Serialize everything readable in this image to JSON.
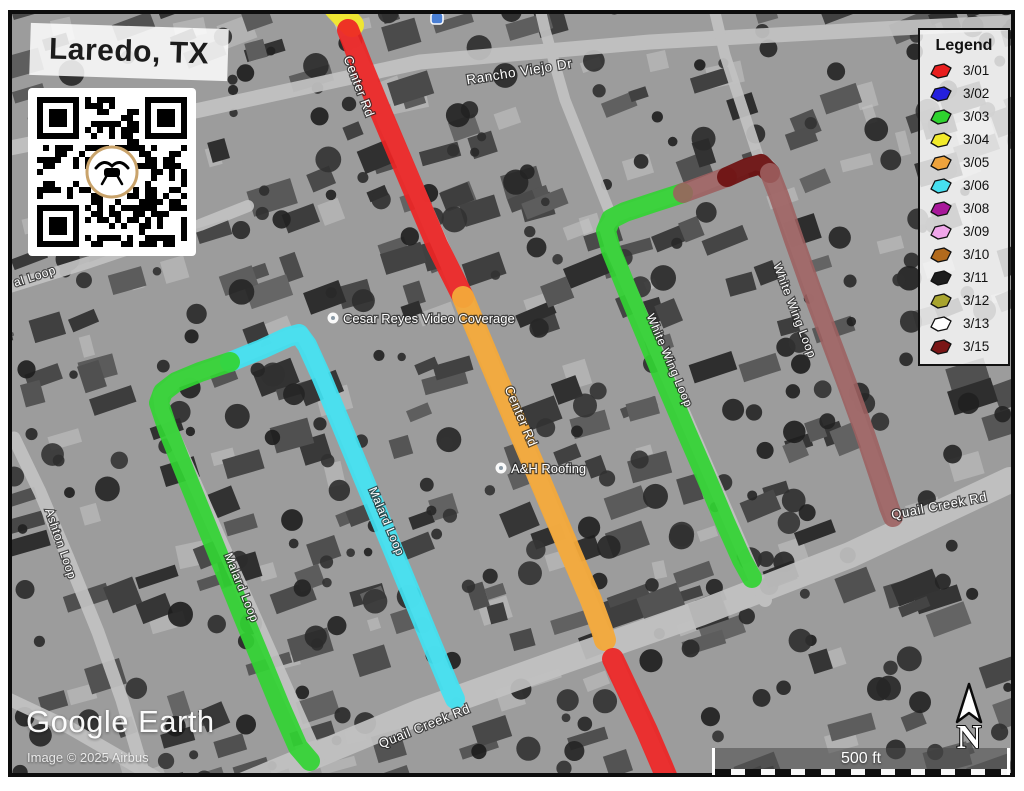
{
  "title": "Laredo, TX",
  "legend": {
    "title": "Legend",
    "entries": [
      {
        "date": "3/01",
        "color": "#e81e1e"
      },
      {
        "date": "3/02",
        "color": "#2420dd"
      },
      {
        "date": "3/03",
        "color": "#2ed32e"
      },
      {
        "date": "3/04",
        "color": "#f2ea2a"
      },
      {
        "date": "3/05",
        "color": "#eea33c"
      },
      {
        "date": "3/06",
        "color": "#46dff0"
      },
      {
        "date": "3/08",
        "color": "#a8189a"
      },
      {
        "date": "3/09",
        "color": "#f0a6ea"
      },
      {
        "date": "3/10",
        "color": "#b26a1c"
      },
      {
        "date": "3/11",
        "color": "#1c1c1c"
      },
      {
        "date": "3/12",
        "color": "#a8a42e"
      },
      {
        "date": "3/13",
        "color": "#ffffff"
      },
      {
        "date": "3/15",
        "color": "#7a1616"
      }
    ]
  },
  "map": {
    "routes": [
      {
        "date": "3/04",
        "name": "center-rd-yellow-stub",
        "color": "#f2e92c",
        "width": 24,
        "opacity": 0.95,
        "points": [
          [
            336,
            8
          ],
          [
            352,
            25
          ]
        ]
      },
      {
        "date": "3/01",
        "name": "center-rd-north",
        "color": "#ee2424",
        "width": 22,
        "opacity": 0.92,
        "points": [
          [
            348,
            30
          ],
          [
            362,
            66
          ],
          [
            380,
            110
          ],
          [
            399,
            155
          ],
          [
            418,
            200
          ],
          [
            437,
            245
          ],
          [
            456,
            283
          ],
          [
            463,
            297
          ]
        ]
      },
      {
        "date": "3/05",
        "name": "center-rd-mid",
        "color": "#f3a93a",
        "width": 22,
        "opacity": 0.95,
        "points": [
          [
            463,
            297
          ],
          [
            478,
            333
          ],
          [
            496,
            376
          ],
          [
            515,
            421
          ],
          [
            534,
            466
          ],
          [
            553,
            511
          ],
          [
            572,
            556
          ],
          [
            591,
            600
          ],
          [
            602,
            630
          ],
          [
            605,
            640
          ]
        ]
      },
      {
        "date": "3/01",
        "name": "center-rd-south",
        "color": "#ee2424",
        "width": 22,
        "opacity": 0.92,
        "points": [
          [
            613,
            659
          ],
          [
            630,
            695
          ],
          [
            647,
            731
          ],
          [
            662,
            766
          ],
          [
            669,
            783
          ]
        ]
      },
      {
        "date": "3/06",
        "name": "malard-loop-east",
        "color": "#41e2f2",
        "width": 20,
        "opacity": 0.92,
        "points": [
          [
            230,
            362
          ],
          [
            262,
            349
          ],
          [
            288,
            337
          ],
          [
            299,
            334
          ],
          [
            307,
            345
          ],
          [
            322,
            378
          ],
          [
            341,
            424
          ],
          [
            360,
            470
          ],
          [
            379,
            516
          ],
          [
            398,
            562
          ],
          [
            417,
            608
          ],
          [
            436,
            654
          ],
          [
            450,
            688
          ],
          [
            455,
            699
          ]
        ]
      },
      {
        "date": "3/03",
        "name": "malard-loop-west",
        "color": "#32d433",
        "width": 20,
        "opacity": 0.92,
        "points": [
          [
            230,
            362
          ],
          [
            200,
            372
          ],
          [
            176,
            382
          ],
          [
            163,
            392
          ],
          [
            159,
            403
          ],
          [
            168,
            430
          ],
          [
            186,
            475
          ],
          [
            205,
            522
          ],
          [
            224,
            569
          ],
          [
            243,
            616
          ],
          [
            262,
            662
          ],
          [
            280,
            706
          ],
          [
            298,
            747
          ],
          [
            310,
            761
          ]
        ]
      },
      {
        "date": "3/03",
        "name": "white-wing-loop-west",
        "color": "#32d433",
        "width": 20,
        "opacity": 0.92,
        "points": [
          [
            683,
            193
          ],
          [
            652,
            203
          ],
          [
            625,
            212
          ],
          [
            611,
            219
          ],
          [
            606,
            231
          ],
          [
            611,
            250
          ],
          [
            628,
            292
          ],
          [
            647,
            338
          ],
          [
            666,
            384
          ],
          [
            686,
            431
          ],
          [
            706,
            477
          ],
          [
            725,
            522
          ],
          [
            742,
            560
          ],
          [
            752,
            578
          ]
        ]
      },
      {
        "date": "3/15",
        "name": "white-wing-loop-north",
        "color": "#9d6060",
        "width": 20,
        "opacity": 0.88,
        "points": [
          [
            683,
            193
          ],
          [
            705,
            185
          ],
          [
            727,
            177
          ]
        ]
      },
      {
        "date": "3/15",
        "name": "white-wing-loop-corner",
        "color": "#6d1212",
        "width": 20,
        "opacity": 0.94,
        "points": [
          [
            727,
            177
          ],
          [
            747,
            168
          ],
          [
            761,
            164
          ],
          [
            770,
            173
          ]
        ]
      },
      {
        "date": "3/15",
        "name": "white-wing-loop-east",
        "color": "#9d6060",
        "width": 20,
        "opacity": 0.88,
        "points": [
          [
            770,
            173
          ],
          [
            779,
            196
          ],
          [
            794,
            240
          ],
          [
            811,
            288
          ],
          [
            829,
            336
          ],
          [
            847,
            384
          ],
          [
            864,
            431
          ],
          [
            879,
            476
          ],
          [
            889,
            507
          ],
          [
            893,
            517
          ]
        ]
      }
    ],
    "street_labels": [
      {
        "text": "Rancho Viejo Dr",
        "x": 520,
        "y": 76,
        "rotate": -9,
        "size": 13.5
      },
      {
        "text": "Center  Rd",
        "x": 355,
        "y": 88,
        "rotate": 69,
        "size": 13
      },
      {
        "text": "Center Rd",
        "x": 517,
        "y": 418,
        "rotate": 67,
        "size": 13
      },
      {
        "text": "Malard Loop",
        "x": 383,
        "y": 523,
        "rotate": 67,
        "size": 12
      },
      {
        "text": "Malard Loop",
        "x": 238,
        "y": 589,
        "rotate": 68,
        "size": 12
      },
      {
        "text": "White Wing Loop",
        "x": 666,
        "y": 362,
        "rotate": 67,
        "size": 12
      },
      {
        "text": "White Wing Loop",
        "x": 791,
        "y": 312,
        "rotate": 69,
        "size": 12
      },
      {
        "text": "Quail Creek Rd",
        "x": 426,
        "y": 730,
        "rotate": -22,
        "size": 13
      },
      {
        "text": "Quail Creek Rd",
        "x": 940,
        "y": 510,
        "rotate": -11,
        "size": 13
      },
      {
        "text": "al Loop",
        "x": 36,
        "y": 280,
        "rotate": -18,
        "size": 12
      },
      {
        "text": "Ashton Loop",
        "x": 57,
        "y": 545,
        "rotate": 71,
        "size": 12
      },
      {
        "text": "sir",
        "x": 8,
        "y": 340,
        "rotate": -12,
        "size": 10
      }
    ],
    "pois": [
      {
        "label": "Cesar Reyes Video Coverage",
        "x": 333,
        "y": 318
      },
      {
        "label": "A&H Roofing",
        "x": 501,
        "y": 468
      }
    ],
    "north_label": "N",
    "scale_label": "500 ft"
  },
  "watermark": {
    "brand": "Google Earth",
    "credit": "Image © 2025 Airbus"
  }
}
